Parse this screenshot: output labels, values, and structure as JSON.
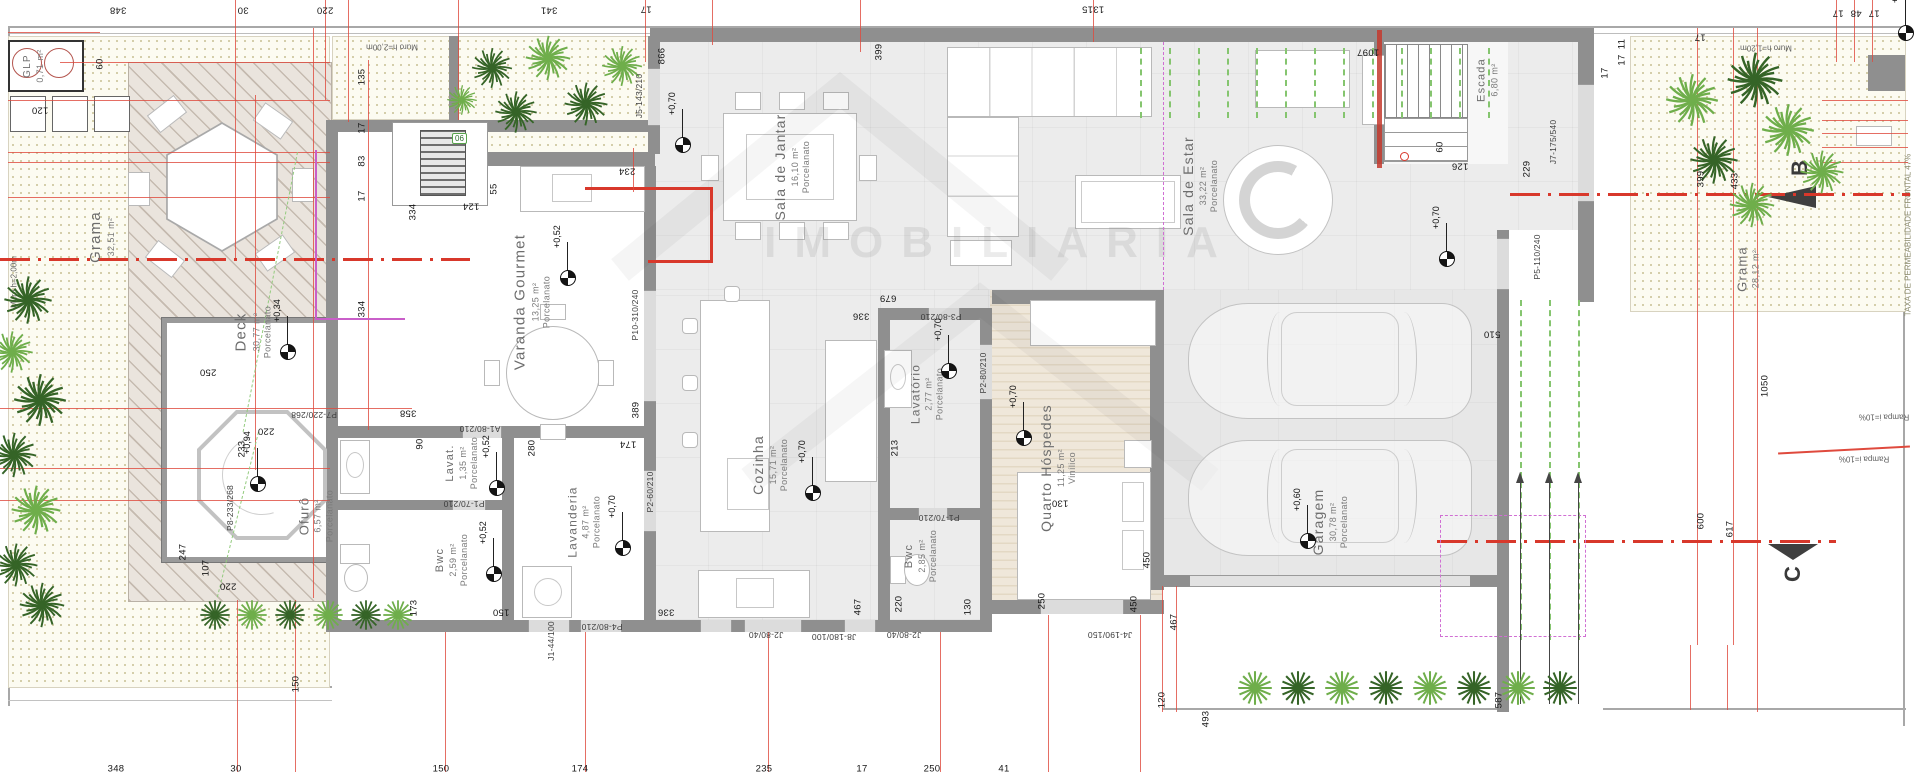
{
  "palette": {
    "dim_red": "#df4a3d",
    "wall_gray": "#8f8f8f",
    "grass_dot": "#c6bf92",
    "green": "#85c56f",
    "magenta": "#d06fd3",
    "section_red": "#d8382b"
  },
  "watermark": {
    "text": "IMOBILIARIA"
  },
  "site_texts": {
    "muro_top": "Muro h=2,00m",
    "muro_left": "Muro h=2,00m",
    "muro_right": "Muro h=1,20m",
    "taxa": "TAXA DE PERMEABILIDADE FRONTAL 47%",
    "rampa_edge": "Rampa i=10%",
    "rampa_bottom": "Rampa i=10%",
    "section_b": "B",
    "section_c": "C",
    "tag_06": "06"
  },
  "rooms": [
    {
      "name": "GLP",
      "area": "0,71 m²",
      "floor": "",
      "x": 34,
      "y": 66,
      "fs": 10
    },
    {
      "name": "Grama",
      "area": "32,51 m²",
      "floor": "",
      "x": 102,
      "y": 237,
      "fs": 15
    },
    {
      "name": "Deck",
      "area": "30,77 m²",
      "floor": "Porcelanato",
      "x": 253,
      "y": 332,
      "fs": 15
    },
    {
      "name": "Ofurô",
      "area": "6,57 m²",
      "floor": "Porcelanato",
      "x": 316,
      "y": 516,
      "fs": 13
    },
    {
      "name": "Varanda Gourmet",
      "area": "13,25 m²",
      "floor": "Porcelanato",
      "x": 532,
      "y": 302,
      "fs": 15
    },
    {
      "name": "Lavat.",
      "area": "1,35 m²",
      "floor": "Porcelanato",
      "x": 462,
      "y": 463,
      "fs": 11
    },
    {
      "name": "Bwc",
      "area": "2,59 m²",
      "floor": "Porcelanato",
      "x": 452,
      "y": 560,
      "fs": 11
    },
    {
      "name": "Lavanderia",
      "area": "4,87 m²",
      "floor": "Porcelanato",
      "x": 584,
      "y": 522,
      "fs": 12
    },
    {
      "name": "Cozinha",
      "area": "15,71 m²",
      "floor": "Porcelanato",
      "x": 770,
      "y": 465,
      "fs": 14
    },
    {
      "name": "Sala de Jantar",
      "area": "16,10 m²",
      "floor": "Porcelanato",
      "x": 792,
      "y": 167,
      "fs": 14
    },
    {
      "name": "Sala de Estar",
      "area": "33,22 m²",
      "floor": "Porcelanato",
      "x": 1200,
      "y": 186,
      "fs": 14
    },
    {
      "name": "Escada",
      "area": "6,80 m²",
      "floor": "",
      "x": 1488,
      "y": 80,
      "fs": 11
    },
    {
      "name": "Lavatório",
      "area": "2,77 m²",
      "floor": "Porcelanato",
      "x": 927,
      "y": 394,
      "fs": 12
    },
    {
      "name": "Bwc",
      "area": "2,85 m²",
      "floor": "Porcelanato",
      "x": 921,
      "y": 556,
      "fs": 11
    },
    {
      "name": "Quarto Hóspedes",
      "area": "11,25 m²",
      "floor": "Vinílico",
      "x": 1058,
      "y": 468,
      "fs": 14
    },
    {
      "name": "Garagem",
      "area": "30,78 m²",
      "floor": "Porcelanato",
      "x": 1330,
      "y": 522,
      "fs": 14
    },
    {
      "name": "Grama",
      "area": "28,12 m²",
      "floor": "",
      "x": 1748,
      "y": 269,
      "fs": 13
    }
  ],
  "levels": [
    {
      "v": "+0,34",
      "x": 288,
      "y": 352
    },
    {
      "v": "+0,94",
      "x": 258,
      "y": 484
    },
    {
      "v": "+0,52",
      "x": 568,
      "y": 278
    },
    {
      "v": "+0,52",
      "x": 497,
      "y": 488
    },
    {
      "v": "+0,52",
      "x": 494,
      "y": 574
    },
    {
      "v": "+0,70",
      "x": 623,
      "y": 548
    },
    {
      "v": "+0,70",
      "x": 813,
      "y": 493
    },
    {
      "v": "+0,70",
      "x": 683,
      "y": 145
    },
    {
      "v": "+0,70",
      "x": 949,
      "y": 371
    },
    {
      "v": "+0,70",
      "x": 1024,
      "y": 438
    },
    {
      "v": "+0,60",
      "x": 1308,
      "y": 541
    },
    {
      "v": "+0,70",
      "x": 1447,
      "y": 259
    },
    {
      "v": "+0,9",
      "x": 1906,
      "y": 33
    }
  ],
  "dimensions": [
    {
      "t": "348",
      "x": 118,
      "y": 10,
      "o": "f"
    },
    {
      "t": "30",
      "x": 243,
      "y": 10,
      "o": "f"
    },
    {
      "t": "220",
      "x": 325,
      "y": 10,
      "o": "f"
    },
    {
      "t": "341",
      "x": 549,
      "y": 10,
      "o": "f"
    },
    {
      "t": "17",
      "x": 646,
      "y": 9,
      "o": "f"
    },
    {
      "t": "1315",
      "x": 1093,
      "y": 9,
      "o": "f"
    },
    {
      "t": "1097",
      "x": 1368,
      "y": 52,
      "o": "f"
    },
    {
      "t": "17",
      "x": 1838,
      "y": 13,
      "o": "f"
    },
    {
      "t": "48",
      "x": 1856,
      "y": 13,
      "o": "f"
    },
    {
      "t": "17",
      "x": 1874,
      "y": 13,
      "o": "f"
    },
    {
      "t": "17",
      "x": 1700,
      "y": 37,
      "o": "f"
    },
    {
      "t": "135",
      "x": 362,
      "y": 77,
      "o": "v"
    },
    {
      "t": "17",
      "x": 362,
      "y": 128,
      "o": "v"
    },
    {
      "t": "83",
      "x": 362,
      "y": 161,
      "o": "v"
    },
    {
      "t": "17",
      "x": 362,
      "y": 196,
      "o": "v"
    },
    {
      "t": "334",
      "x": 362,
      "y": 309,
      "o": "v"
    },
    {
      "t": "334",
      "x": 413,
      "y": 212,
      "o": "v"
    },
    {
      "t": "60",
      "x": 100,
      "y": 64,
      "o": "v"
    },
    {
      "t": "120",
      "x": 40,
      "y": 110,
      "o": "f"
    },
    {
      "t": "250",
      "x": 208,
      "y": 372,
      "o": "f"
    },
    {
      "t": "233",
      "x": 242,
      "y": 449,
      "o": "v"
    },
    {
      "t": "220",
      "x": 266,
      "y": 431,
      "o": "f"
    },
    {
      "t": "247",
      "x": 183,
      "y": 552,
      "o": "v"
    },
    {
      "t": "107",
      "x": 206,
      "y": 568,
      "o": "v"
    },
    {
      "t": "220",
      "x": 228,
      "y": 586,
      "o": "f"
    },
    {
      "t": "150",
      "x": 296,
      "y": 684,
      "o": "v"
    },
    {
      "t": "358",
      "x": 408,
      "y": 413,
      "o": "f"
    },
    {
      "t": "90",
      "x": 420,
      "y": 444,
      "o": "v"
    },
    {
      "t": "280",
      "x": 532,
      "y": 448,
      "o": "v"
    },
    {
      "t": "389",
      "x": 636,
      "y": 410,
      "o": "v"
    },
    {
      "t": "174",
      "x": 628,
      "y": 444,
      "o": "f"
    },
    {
      "t": "124",
      "x": 471,
      "y": 206,
      "o": "f"
    },
    {
      "t": "55",
      "x": 494,
      "y": 189,
      "o": "v"
    },
    {
      "t": "173",
      "x": 414,
      "y": 608,
      "o": "v"
    },
    {
      "t": "150",
      "x": 501,
      "y": 612,
      "o": "f"
    },
    {
      "t": "336",
      "x": 666,
      "y": 612,
      "o": "f"
    },
    {
      "t": "234",
      "x": 627,
      "y": 171,
      "o": "f"
    },
    {
      "t": "866",
      "x": 662,
      "y": 56,
      "o": "v"
    },
    {
      "t": "399",
      "x": 879,
      "y": 52,
      "o": "v"
    },
    {
      "t": "679",
      "x": 888,
      "y": 298,
      "o": "f"
    },
    {
      "t": "336",
      "x": 861,
      "y": 316,
      "o": "f"
    },
    {
      "t": "213",
      "x": 895,
      "y": 448,
      "o": "v"
    },
    {
      "t": "130",
      "x": 1060,
      "y": 503,
      "o": "f"
    },
    {
      "t": "450",
      "x": 1147,
      "y": 560,
      "o": "v"
    },
    {
      "t": "467",
      "x": 1174,
      "y": 622,
      "o": "v"
    },
    {
      "t": "467",
      "x": 858,
      "y": 607,
      "o": "v"
    },
    {
      "t": "220",
      "x": 899,
      "y": 604,
      "o": "v"
    },
    {
      "t": "130",
      "x": 968,
      "y": 607,
      "o": "v"
    },
    {
      "t": "250",
      "x": 1042,
      "y": 601,
      "o": "v"
    },
    {
      "t": "450",
      "x": 1134,
      "y": 604,
      "o": "v"
    },
    {
      "t": "60",
      "x": 1440,
      "y": 147,
      "o": "v"
    },
    {
      "t": "126",
      "x": 1460,
      "y": 166,
      "o": "f"
    },
    {
      "t": "229",
      "x": 1527,
      "y": 169,
      "o": "v"
    },
    {
      "t": "510",
      "x": 1492,
      "y": 334,
      "o": "f"
    },
    {
      "t": "11",
      "x": 1622,
      "y": 44,
      "o": "v"
    },
    {
      "t": "17",
      "x": 1622,
      "y": 60,
      "o": "v"
    },
    {
      "t": "17",
      "x": 1605,
      "y": 73,
      "o": "v"
    },
    {
      "t": "399",
      "x": 1701,
      "y": 179,
      "o": "v"
    },
    {
      "t": "433",
      "x": 1735,
      "y": 181,
      "o": "v"
    },
    {
      "t": "1050",
      "x": 1765,
      "y": 386,
      "o": "v"
    },
    {
      "t": "600",
      "x": 1701,
      "y": 521,
      "o": "v"
    },
    {
      "t": "617",
      "x": 1730,
      "y": 529,
      "o": "v"
    },
    {
      "t": "120",
      "x": 1162,
      "y": 700,
      "o": "v"
    },
    {
      "t": "493",
      "x": 1206,
      "y": 719,
      "o": "v"
    },
    {
      "t": "587",
      "x": 1499,
      "y": 700,
      "o": "v"
    },
    {
      "t": "348",
      "x": 116,
      "y": 769,
      "o": "h"
    },
    {
      "t": "30",
      "x": 236,
      "y": 769,
      "o": "h"
    },
    {
      "t": "150",
      "x": 441,
      "y": 769,
      "o": "h"
    },
    {
      "t": "174",
      "x": 580,
      "y": 769,
      "o": "h"
    },
    {
      "t": "235",
      "x": 764,
      "y": 769,
      "o": "h"
    },
    {
      "t": "17",
      "x": 862,
      "y": 769,
      "o": "h"
    },
    {
      "t": "250",
      "x": 932,
      "y": 769,
      "o": "h"
    },
    {
      "t": "41",
      "x": 1004,
      "y": 769,
      "o": "h"
    }
  ],
  "door_labels": [
    {
      "t": "P7-220/268",
      "x": 314,
      "y": 415,
      "o": "f"
    },
    {
      "t": "P8-233/268",
      "x": 230,
      "y": 508,
      "o": "v"
    },
    {
      "t": "A1-80/210",
      "x": 480,
      "y": 429,
      "o": "f"
    },
    {
      "t": "P1-70/210",
      "x": 464,
      "y": 504,
      "o": "f"
    },
    {
      "t": "P2-60/210",
      "x": 650,
      "y": 492,
      "o": "v"
    },
    {
      "t": "P10-310/240",
      "x": 635,
      "y": 315,
      "o": "v"
    },
    {
      "t": "J5-143/210",
      "x": 639,
      "y": 96,
      "o": "v"
    },
    {
      "t": "P4-80/210",
      "x": 602,
      "y": 627,
      "o": "f"
    },
    {
      "t": "J1-44/100",
      "x": 551,
      "y": 641,
      "o": "v"
    },
    {
      "t": "P3-80/210",
      "x": 941,
      "y": 317,
      "o": "f"
    },
    {
      "t": "P1-70/210",
      "x": 939,
      "y": 518,
      "o": "f"
    },
    {
      "t": "P2-80/210",
      "x": 983,
      "y": 373,
      "o": "v"
    },
    {
      "t": "J7-175/540",
      "x": 1553,
      "y": 142,
      "o": "v"
    },
    {
      "t": "P5-110/240",
      "x": 1537,
      "y": 257,
      "o": "v"
    },
    {
      "t": "J2-80/40",
      "x": 766,
      "y": 635,
      "o": "f"
    },
    {
      "t": "J8-180/100",
      "x": 834,
      "y": 637,
      "o": "f"
    },
    {
      "t": "J2-80/40",
      "x": 904,
      "y": 635,
      "o": "f"
    },
    {
      "t": "J4-190/150",
      "x": 1110,
      "y": 635,
      "o": "f"
    }
  ]
}
